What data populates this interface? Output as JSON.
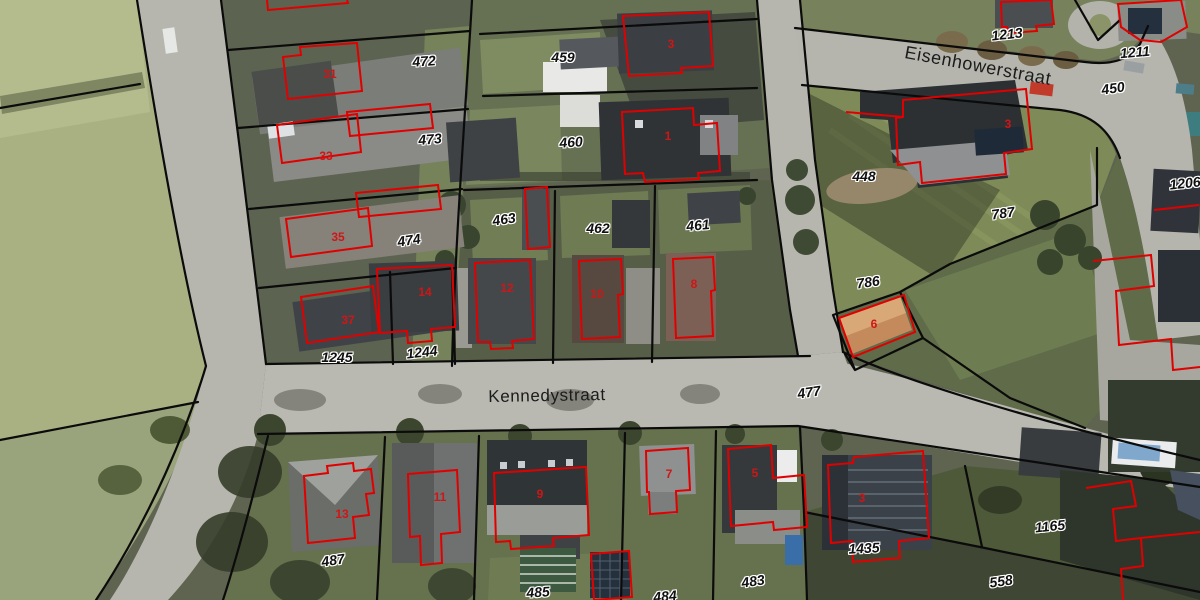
{
  "map": {
    "streets": [
      {
        "name": "Eisenhowerstraat",
        "x": 978,
        "y": 66,
        "rot": 10.5,
        "size": 18
      },
      {
        "name": "Kennedystraat",
        "x": 547,
        "y": 396,
        "rot": -1,
        "size": 17
      }
    ],
    "parcel_labels": [
      {
        "text": "472",
        "x": 424,
        "y": 61,
        "rot": -4
      },
      {
        "text": "459",
        "x": 563,
        "y": 57,
        "rot": 0
      },
      {
        "text": "473",
        "x": 430,
        "y": 139,
        "rot": -5
      },
      {
        "text": "460",
        "x": 571,
        "y": 142,
        "rot": -4
      },
      {
        "text": "474",
        "x": 409,
        "y": 240,
        "rot": -8
      },
      {
        "text": "463",
        "x": 504,
        "y": 219,
        "rot": -8
      },
      {
        "text": "462",
        "x": 598,
        "y": 228,
        "rot": 0
      },
      {
        "text": "461",
        "x": 698,
        "y": 225,
        "rot": -5
      },
      {
        "text": "448",
        "x": 864,
        "y": 176,
        "rot": 0
      },
      {
        "text": "786",
        "x": 868,
        "y": 282,
        "rot": -8
      },
      {
        "text": "787",
        "x": 1003,
        "y": 213,
        "rot": -8
      },
      {
        "text": "1213",
        "x": 1007,
        "y": 34,
        "rot": -6
      },
      {
        "text": "1211",
        "x": 1135,
        "y": 52,
        "rot": -5
      },
      {
        "text": "450",
        "x": 1113,
        "y": 88,
        "rot": -8
      },
      {
        "text": "1206",
        "x": 1185,
        "y": 183,
        "rot": -6
      },
      {
        "text": "1245",
        "x": 337,
        "y": 357,
        "rot": 0
      },
      {
        "text": "1244",
        "x": 422,
        "y": 352,
        "rot": -6
      },
      {
        "text": "477",
        "x": 809,
        "y": 392,
        "rot": -8
      },
      {
        "text": "487",
        "x": 333,
        "y": 560,
        "rot": -8
      },
      {
        "text": "485",
        "x": 538,
        "y": 592,
        "rot": -4
      },
      {
        "text": "484",
        "x": 665,
        "y": 596,
        "rot": -5
      },
      {
        "text": "483",
        "x": 753,
        "y": 581,
        "rot": -8
      },
      {
        "text": "1435",
        "x": 864,
        "y": 548,
        "rot": -3
      },
      {
        "text": "1165",
        "x": 1050,
        "y": 526,
        "rot": -6
      },
      {
        "text": "558",
        "x": 1001,
        "y": 581,
        "rot": -8
      }
    ],
    "building_numbers": [
      {
        "text": "31",
        "x": 330,
        "y": 74
      },
      {
        "text": "33",
        "x": 326,
        "y": 156
      },
      {
        "text": "35",
        "x": 338,
        "y": 237
      },
      {
        "text": "37",
        "x": 348,
        "y": 320
      },
      {
        "text": "3",
        "x": 671,
        "y": 44
      },
      {
        "text": "1",
        "x": 668,
        "y": 136
      },
      {
        "text": "14",
        "x": 425,
        "y": 292
      },
      {
        "text": "12",
        "x": 507,
        "y": 288
      },
      {
        "text": "10",
        "x": 597,
        "y": 294
      },
      {
        "text": "8",
        "x": 694,
        "y": 284
      },
      {
        "text": "3",
        "x": 1008,
        "y": 124
      },
      {
        "text": "6",
        "x": 874,
        "y": 324
      },
      {
        "text": "13",
        "x": 342,
        "y": 514
      },
      {
        "text": "11",
        "x": 440,
        "y": 497
      },
      {
        "text": "9",
        "x": 540,
        "y": 494
      },
      {
        "text": "7",
        "x": 669,
        "y": 474
      },
      {
        "text": "5",
        "x": 755,
        "y": 473
      },
      {
        "text": "3",
        "x": 862,
        "y": 498
      }
    ],
    "colors": {
      "parcel_boundary": "#0b0b0b",
      "building_outline": "#e10000",
      "building_number": "#cf1616",
      "parcel_label_text": "#101010",
      "parcel_label_halo": "#ffffff",
      "street_text": "#1b1b1b",
      "road": "#b7b7b0",
      "field_green": "#a9b183"
    }
  }
}
